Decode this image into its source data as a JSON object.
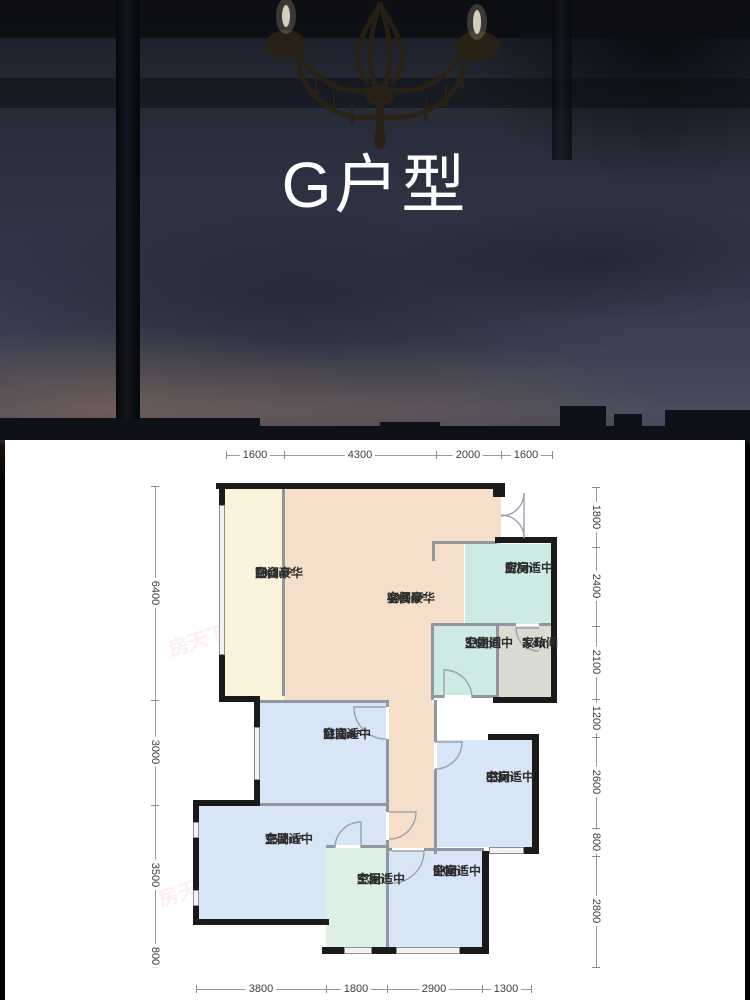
{
  "title": "G户型",
  "watermark": "房天下 fang.com",
  "palette": {
    "wall": "#1a1a1a",
    "partition": "#9097a0",
    "balcony_fill": "#f8f5dc",
    "living_fill": "#f5dfca",
    "kitchen_fill": "#cdebe4",
    "utility_fill": "#dbdcd1",
    "bedroom_fill": "#d8e5f7",
    "master_bath_fill": "#def0e5",
    "dim_text": "#3c3c3c",
    "title_color": "#ffffff"
  },
  "rooms": {
    "balcony": {
      "area": "10.2m²",
      "name": "阳台",
      "quality": "空间豪华"
    },
    "living": {
      "area": "40.1m²",
      "name": "客餐厅",
      "quality": "空间豪华"
    },
    "kitchen": {
      "area": "5.7m²",
      "name": "厨房",
      "quality": "空间适中"
    },
    "bath": {
      "area": "3.6m²",
      "name": "卫生间",
      "quality": "空间适中"
    },
    "utility": {
      "area": "3.4m²",
      "name": "家政间"
    },
    "bedroomA": {
      "area": "11.1m²",
      "name": "卧室A",
      "quality": "空间适中"
    },
    "study": {
      "area": "8.3m²",
      "name": "书房",
      "quality": "空间适中"
    },
    "master": {
      "area": "15.2m²",
      "name": "主卧",
      "quality": "空间适中"
    },
    "masterBath": {
      "area": "5.3m²",
      "name": "主卫",
      "quality": "空间适中"
    },
    "bedroom": {
      "area": "9.0m²",
      "name": "卧室",
      "quality": "空间适中"
    }
  },
  "dimensions": {
    "top": [
      "1600",
      "4300",
      "2000",
      "1600"
    ],
    "left": [
      "6400",
      "3000",
      "3500",
      "800"
    ],
    "right": [
      "1800",
      "2400",
      "2100",
      "1200",
      "2600",
      "800",
      "2800"
    ],
    "bottom": [
      "3800",
      "1800",
      "2900",
      "1300"
    ]
  }
}
